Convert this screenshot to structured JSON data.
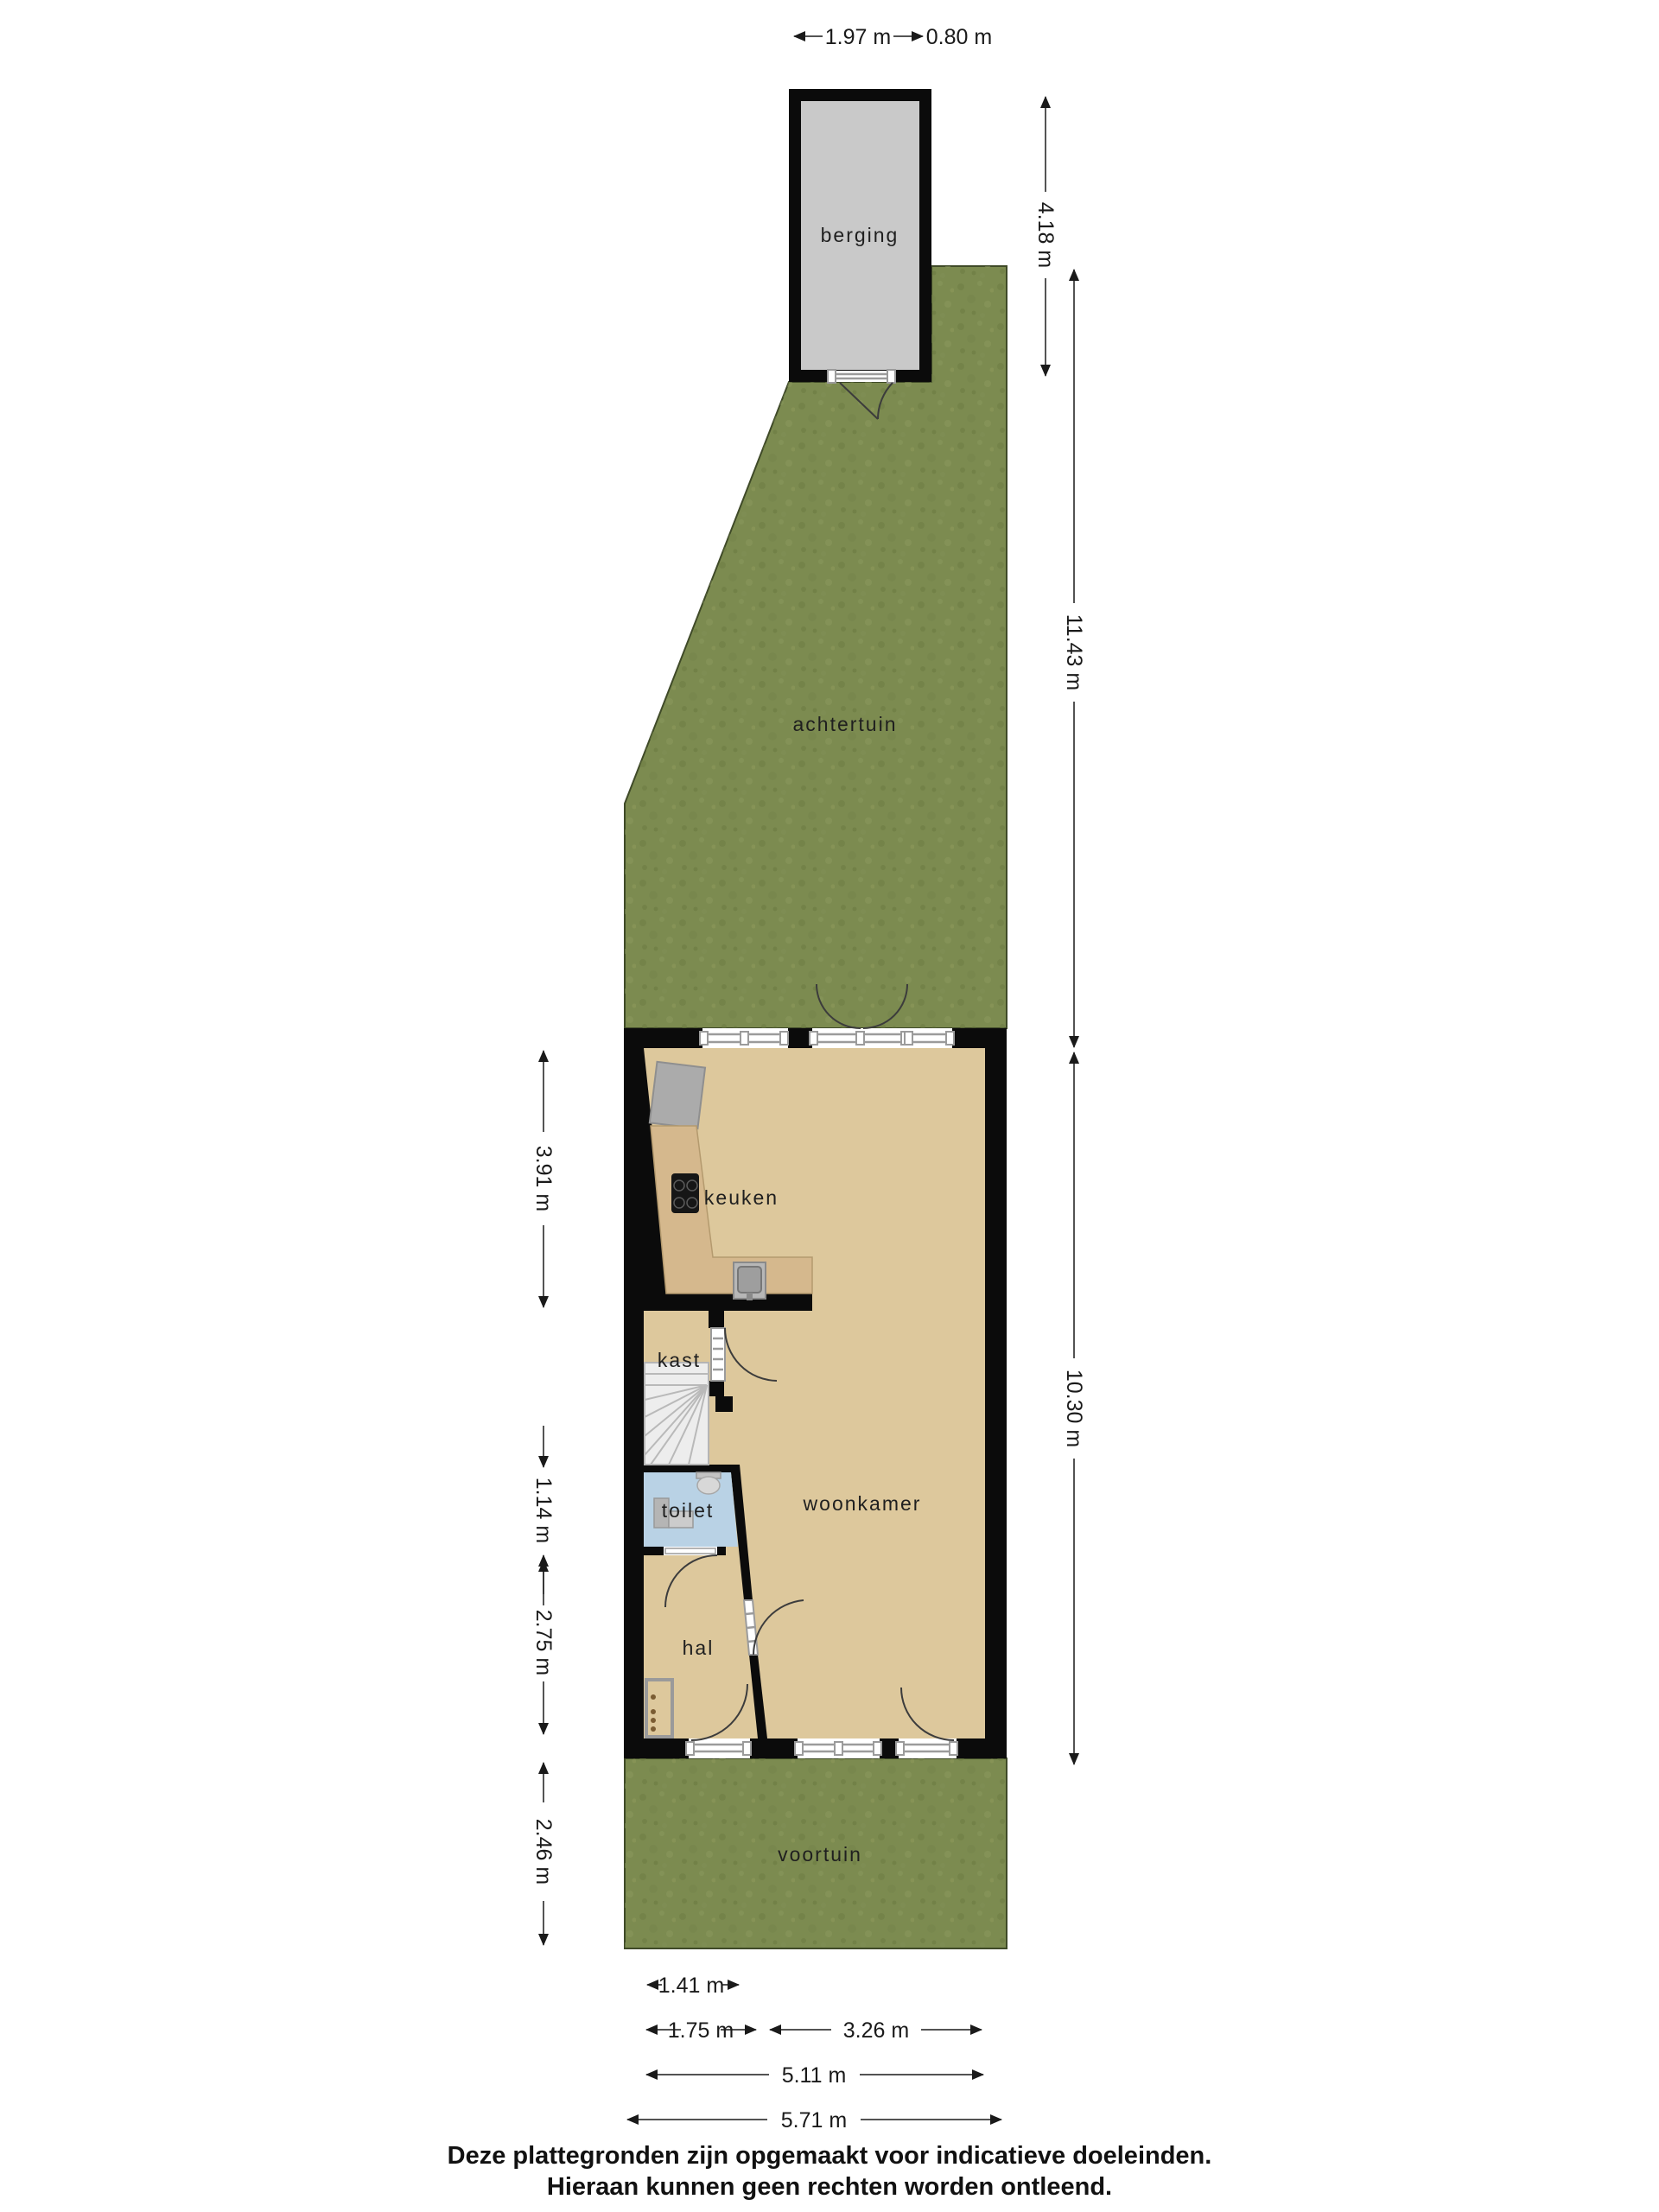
{
  "document": {
    "footer_line1": "Deze plattegronden zijn opgemaakt voor indicatieve doeleinden.",
    "footer_line2": "Hieraan kunnen geen rechten worden ontleend."
  },
  "rooms": {
    "berging": "berging",
    "achtertuin": "achtertuin",
    "keuken": "keuken",
    "kast": "kast",
    "toilet": "toilet",
    "hal": "hal",
    "woonkamer": "woonkamer",
    "voortuin": "voortuin"
  },
  "dimensions": {
    "berging_width": "1.97 m",
    "berging_side_strip": "0.80 m",
    "berging_depth": "4.18 m",
    "achtertuin_depth": "11.43 m",
    "house_depth": "10.30 m",
    "keuken_depth": "3.91 m",
    "toilet_depth": "1.14 m",
    "hal_depth": "2.75 m",
    "voortuin_depth": "2.46 m",
    "hal_width": "1.41 m",
    "front_door_section": "1.75 m",
    "front_window_section": "3.26 m",
    "house_inner_width": "5.11 m",
    "house_outer_width": "5.71 m"
  },
  "colors": {
    "grass": "#7c8b50",
    "grass_border": "#3f4a28",
    "wall": "#0b0b0b",
    "floor": "#ddc89c",
    "berging_floor": "#c9c9c9",
    "toilet_floor": "#b9d2e5",
    "counter": "#d5b88d",
    "stairs": "#ededed"
  }
}
